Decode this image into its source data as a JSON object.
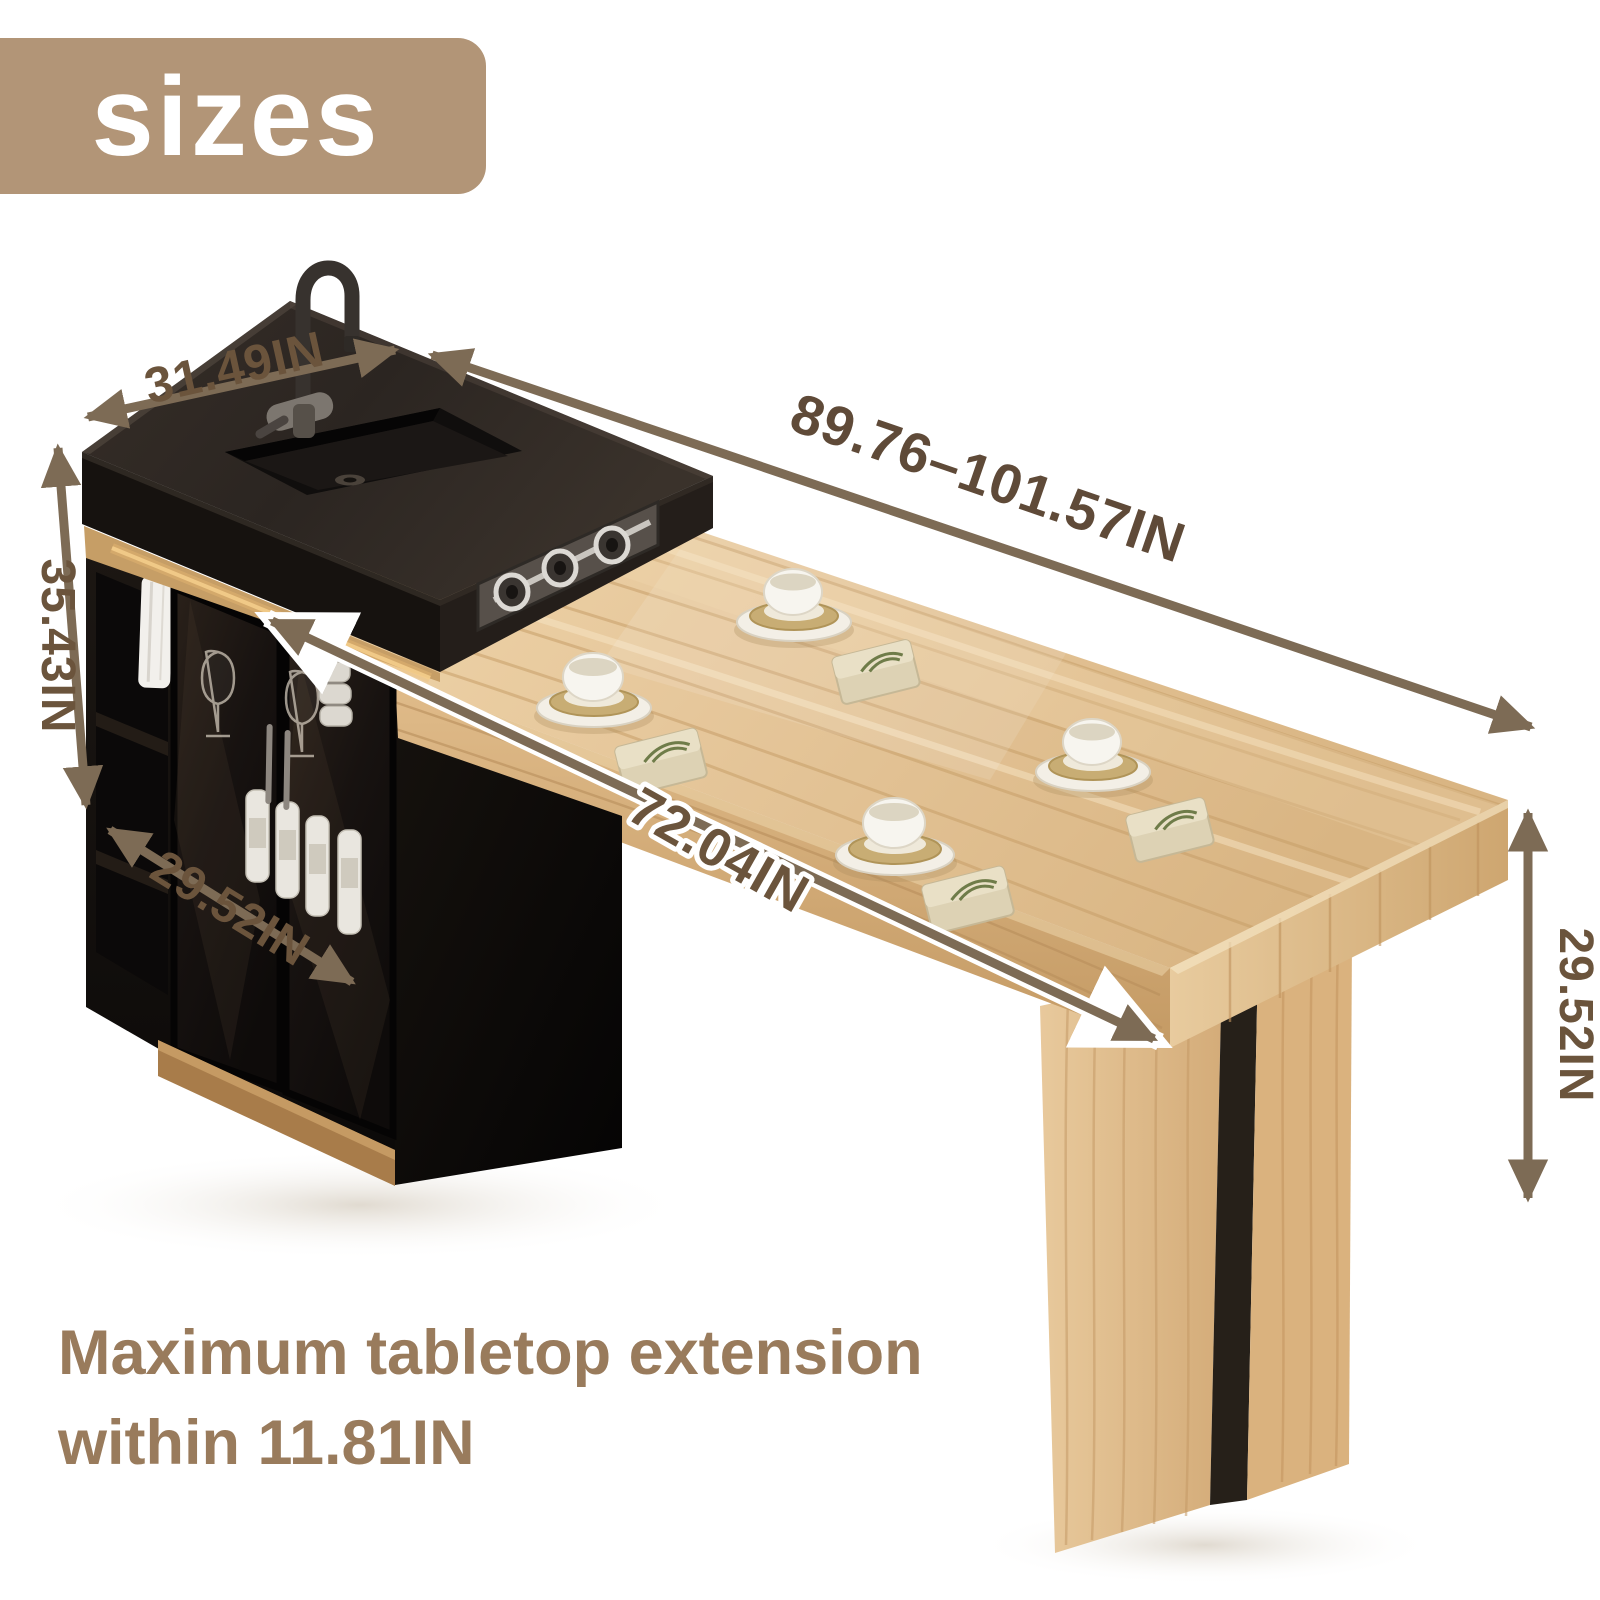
{
  "badge": {
    "label": "sizes",
    "bg": "#b29577",
    "text_color": "#ffffff"
  },
  "dimensions": {
    "island_top_width": "31.49IN",
    "overall_length": "89.76–101.57IN",
    "island_height": "35.43IN",
    "island_depth": "29.52IN",
    "tabletop_length": "72.04IN",
    "table_height": "29.52IN"
  },
  "caption": {
    "line1": "Maximum tabletop extension",
    "line2": "within 11.81IN"
  },
  "colors": {
    "annotation_text": "#6b543c",
    "arrow": "#7d6b55",
    "caption_text": "#997b5c",
    "badge_bg": "#b29577",
    "wood_light": "#e6c79b",
    "counter_black": "#2b2521"
  }
}
